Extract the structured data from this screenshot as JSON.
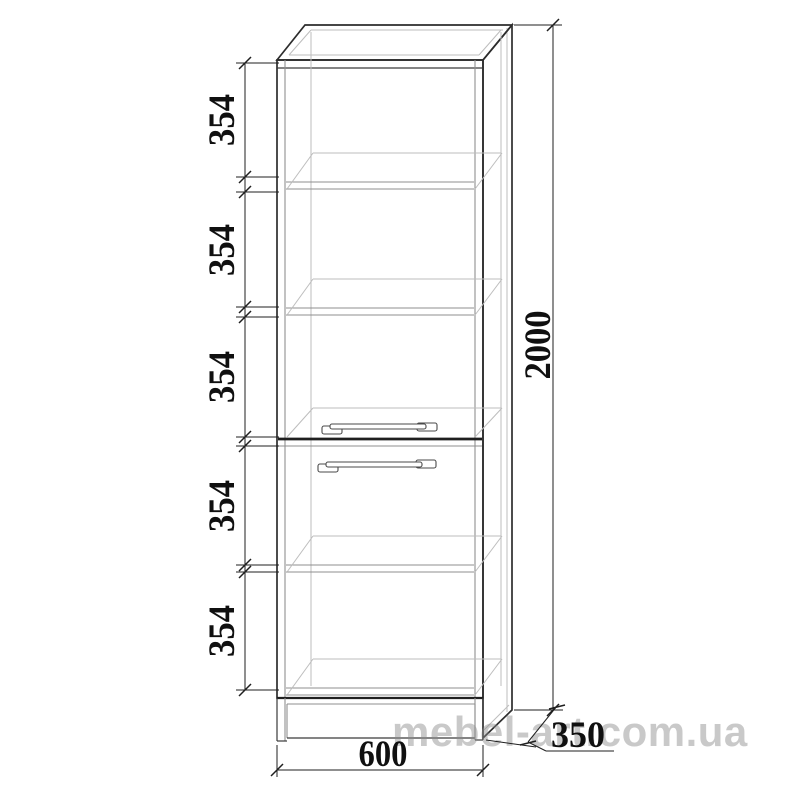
{
  "page": {
    "background": "#ffffff"
  },
  "drawing": {
    "labels": {
      "section_heights": [
        "354",
        "354",
        "354",
        "354",
        "354"
      ],
      "total_height": "2000",
      "width": "600",
      "depth": "350"
    },
    "watermark": "mebel-art.com.ua",
    "colors": {
      "outline": "#2d2d2d",
      "secondary_line": "#8f8f8f",
      "light_line": "#bdbdbd",
      "dimension_line": "#1f1f1f",
      "label_text": "#101010",
      "watermark_text": "#c6c6c6",
      "background": "#ffffff"
    }
  }
}
